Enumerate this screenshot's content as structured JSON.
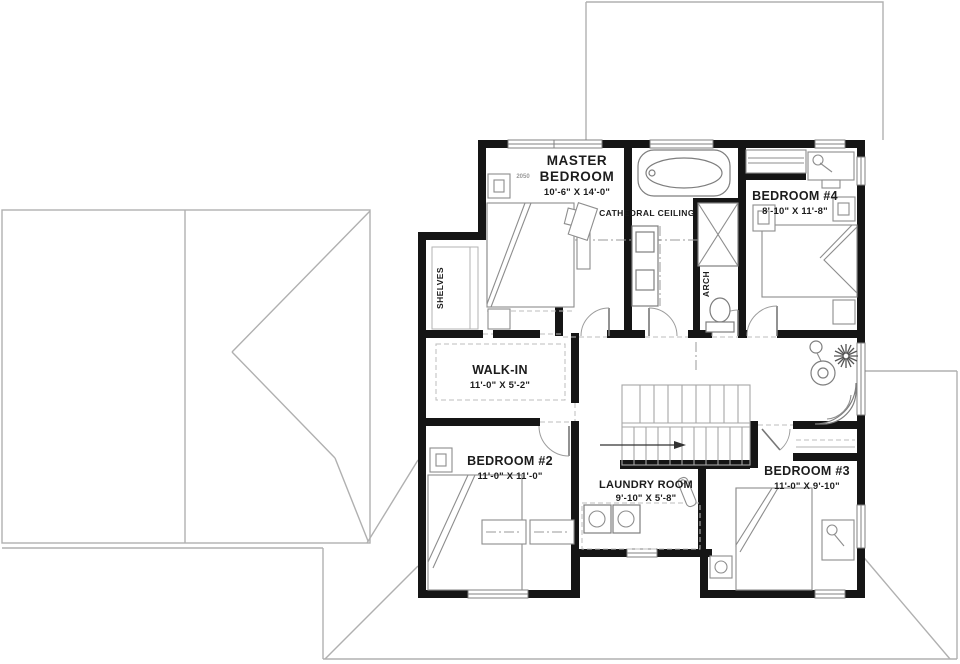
{
  "plan": {
    "rooms": {
      "master": {
        "lines": [
          "MASTER",
          "BEDROOM"
        ],
        "dims": "10'-6\" X 14'-0\""
      },
      "bedroom4": {
        "name": "BEDROOM #4",
        "dims": "8'-10\" X 11'-8\""
      },
      "walkin": {
        "name": "WALK-IN",
        "dims": "11'-0\" X 5'-2\""
      },
      "bedroom2": {
        "name": "BEDROOM #2",
        "dims": "11'-0\" X 11'-0\""
      },
      "laundry": {
        "name": "LAUNDRY ROOM",
        "dims": "9'-10\" X 5'-8\""
      },
      "bedroom3": {
        "name": "BEDROOM #3",
        "dims": "11'-0\" X 9'-10\""
      }
    },
    "annotations": {
      "cathedral_ceiling": "CATHEDRAL CEILING",
      "shelves": "SHELVES",
      "arch": "ARCH",
      "window_tag": "2050"
    },
    "colors": {
      "wall": "#151515",
      "roof_line": "#b0b0b0",
      "furniture_line": "#8d8d8d",
      "background": "#ffffff"
    }
  }
}
